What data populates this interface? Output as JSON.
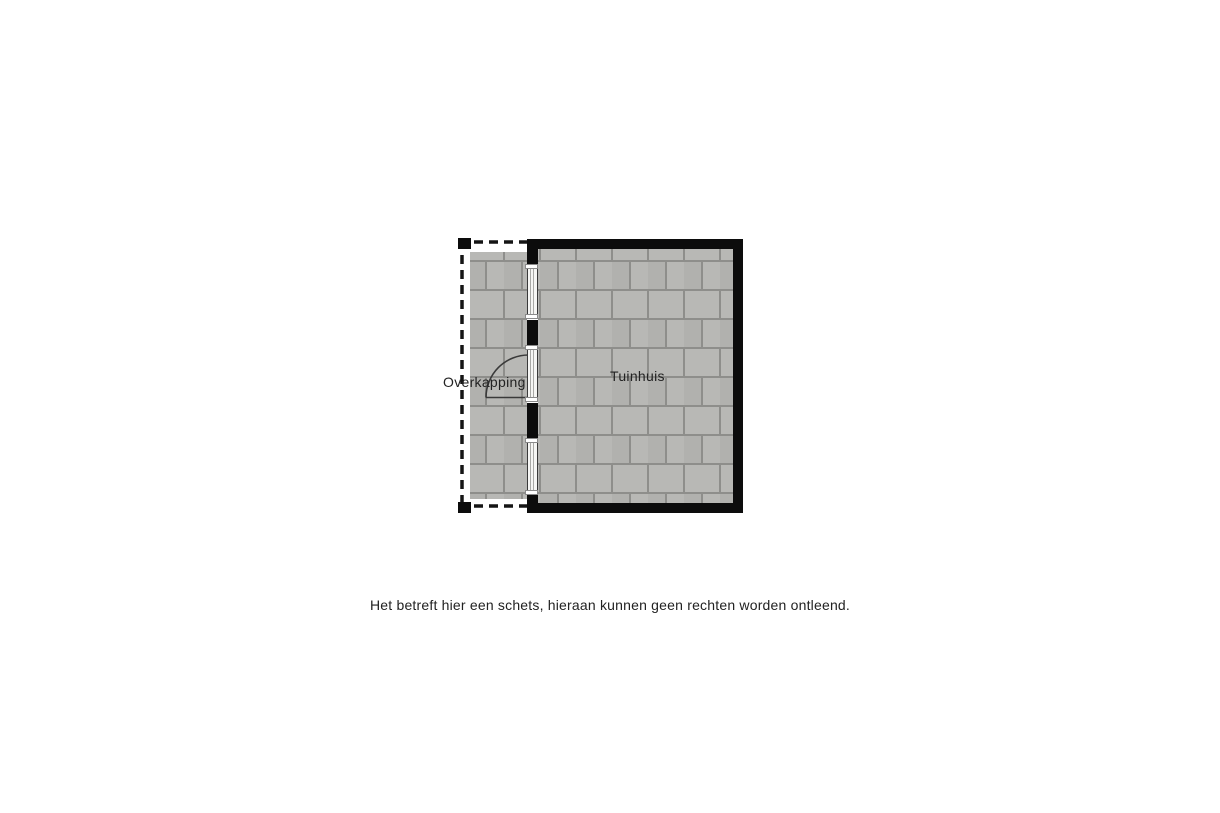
{
  "floorplan": {
    "labels": {
      "overkapping": "Overkapping",
      "tuinhuis": "Tuinhuis"
    },
    "rooms": [
      {
        "id": "overkapping",
        "label": "Overkapping"
      },
      {
        "id": "tuinhuis",
        "label": "Tuinhuis"
      }
    ]
  },
  "disclaimer": "Het betreft hier een schets, hieraan kunnen geen rechten worden ontleend.",
  "colors": {
    "wall": "#0c0c0c",
    "tile": "#b8b8b5",
    "tile2": "#b1b1ae",
    "tile-gap": "#8e8e8b",
    "line": "#3a3a3a",
    "text": "#222222",
    "sill-bg": "#ffffff",
    "sill-border": "#8a8a8a",
    "win-bg": "#f6f6f4"
  }
}
